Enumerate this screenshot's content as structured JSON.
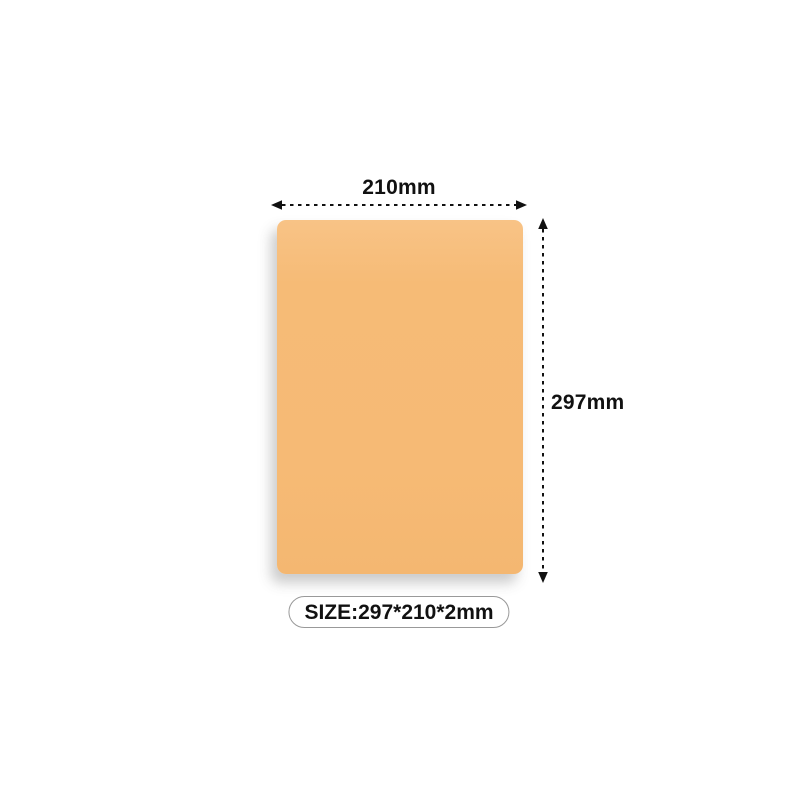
{
  "diagram": {
    "background_color": "#ffffff",
    "product": {
      "description": "plain rectangular sheet",
      "fill_color": "#f6bb76",
      "fill_highlight_color": "#f8c386",
      "corner_radius_px": 9
    },
    "dimensions": {
      "width_label": "210mm",
      "height_label": "297mm"
    },
    "size_badge": {
      "label": "SIZE:297*210*2mm",
      "border_color": "#999999",
      "text_color": "#111111"
    },
    "arrow_color": "#111111",
    "label_text_color": "#111111",
    "icons": {
      "width_arrow": "double-headed-dashed-arrow-horizontal",
      "height_arrow": "double-headed-dashed-arrow-vertical"
    }
  }
}
